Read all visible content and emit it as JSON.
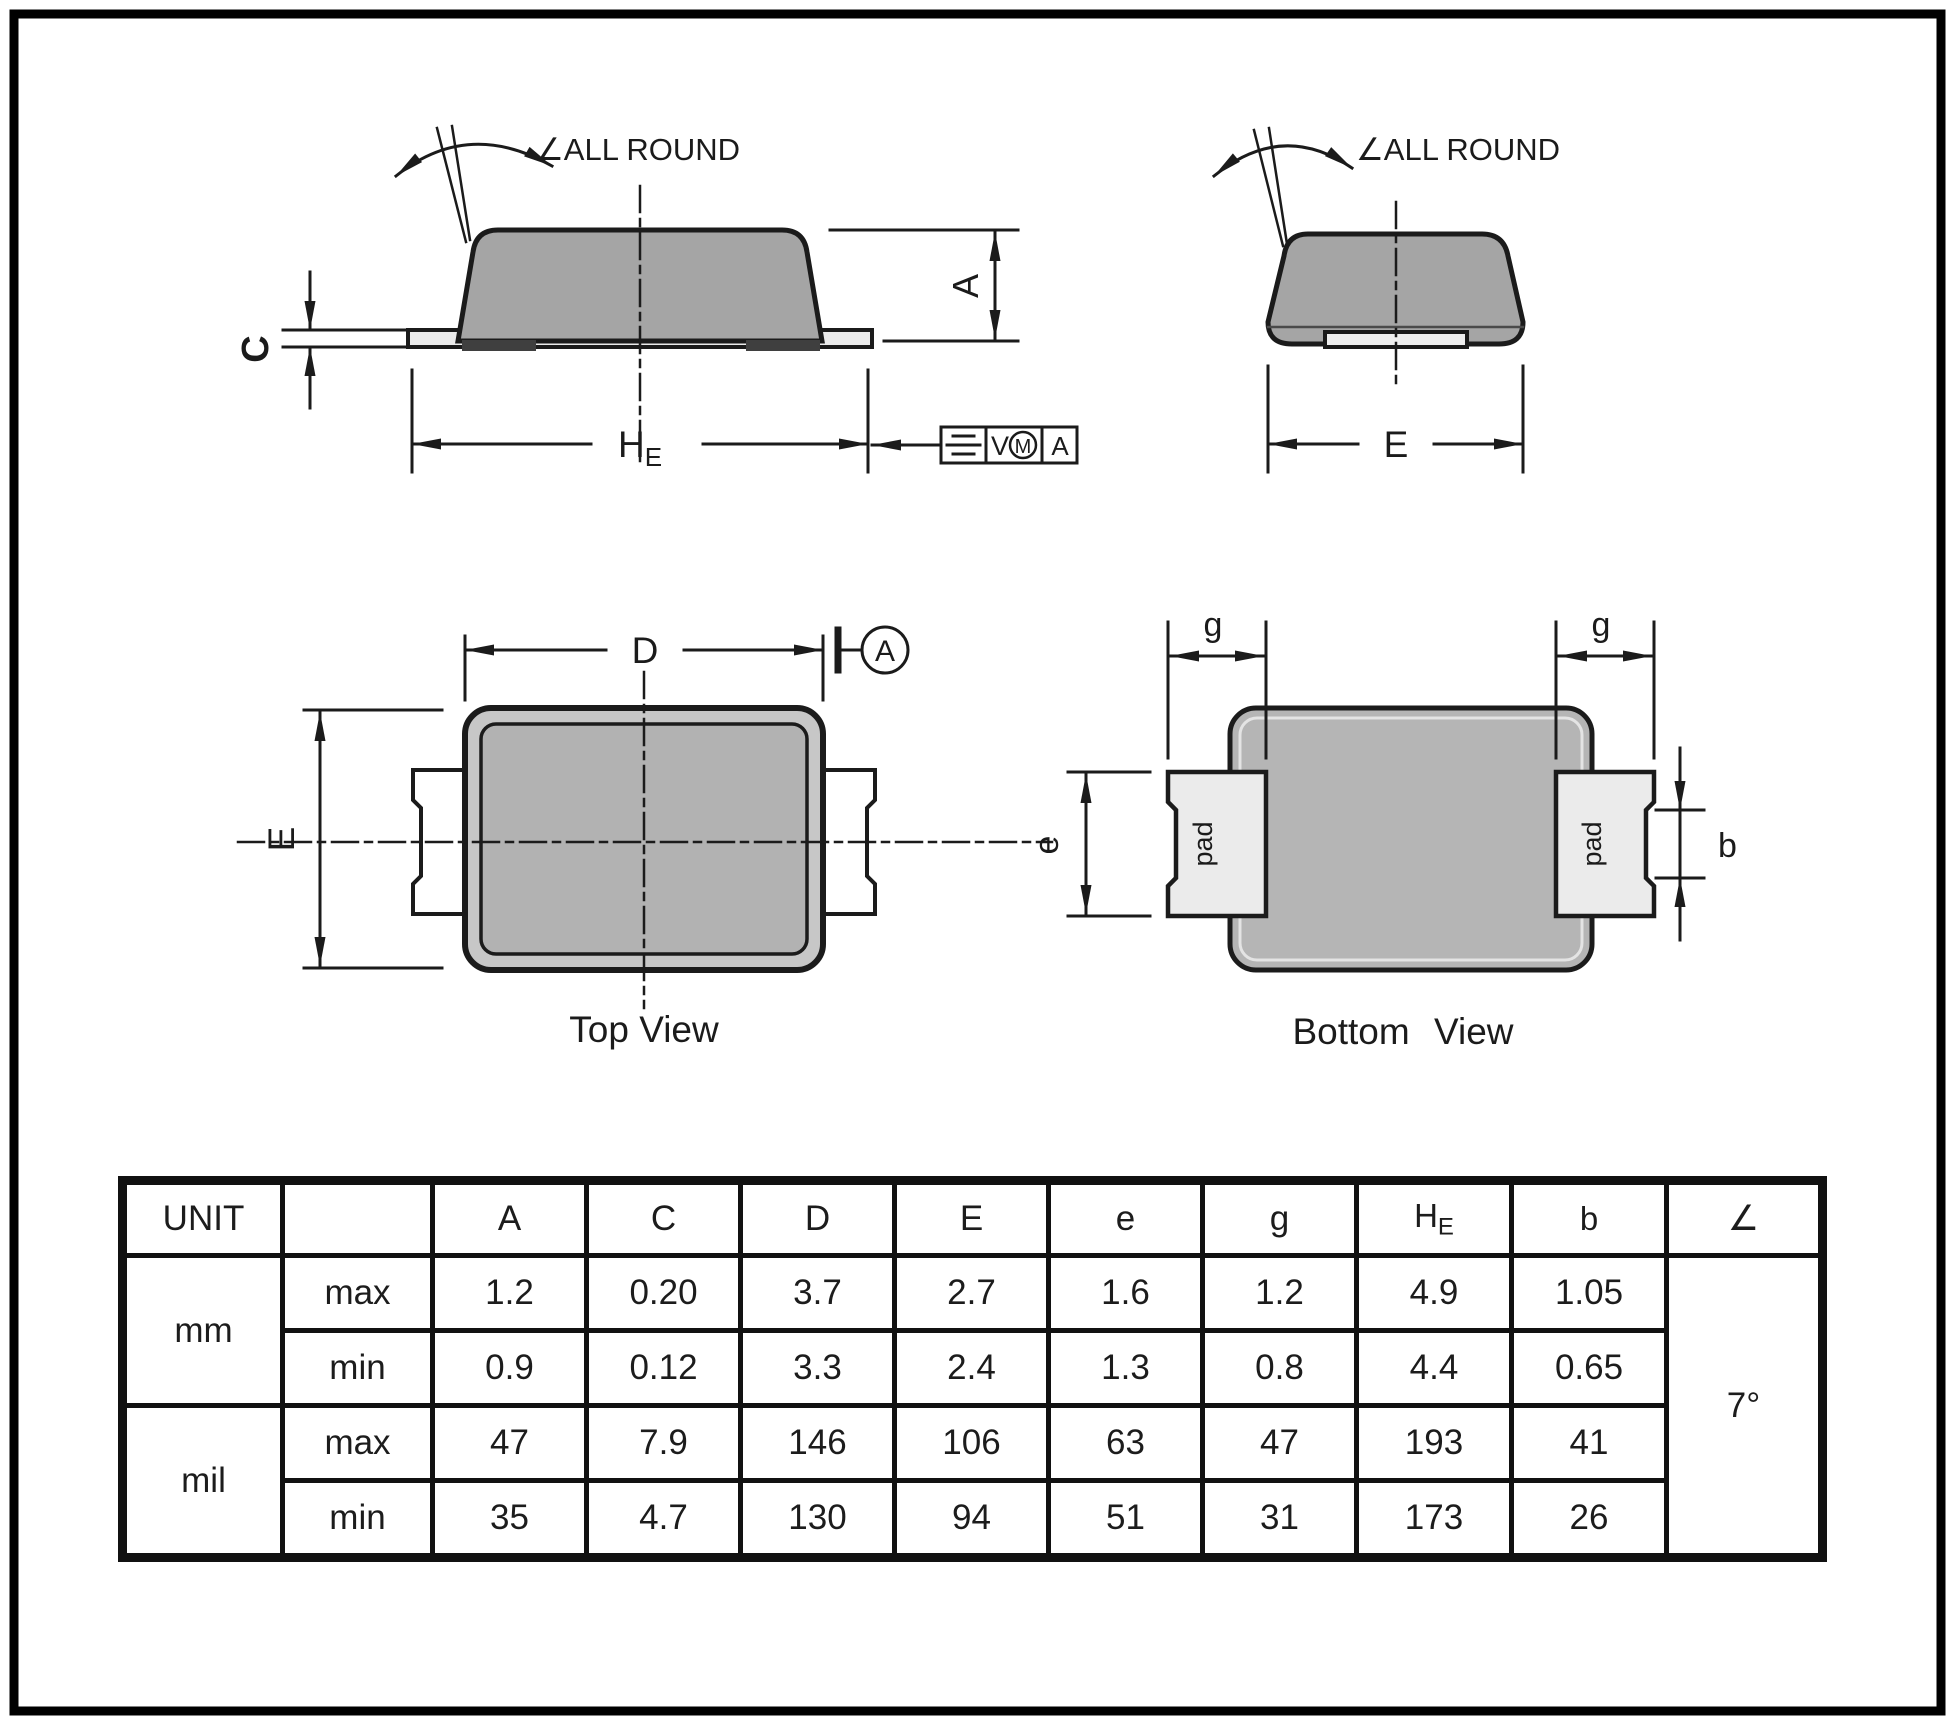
{
  "side_view": {
    "all_round": "∠ALL ROUND",
    "dim_c": "C",
    "dim_a": "A",
    "he_main": "H",
    "he_sub": "E",
    "fcf": {
      "v": "V",
      "m": "M",
      "datum": "A"
    }
  },
  "end_view": {
    "all_round": "∠ALL ROUND",
    "dim_e": "E"
  },
  "top_view": {
    "dim_d": "D",
    "dim_e": "E",
    "datum": "A",
    "caption": "Top View"
  },
  "bottom_view": {
    "g_left": "g",
    "g_right": "g",
    "dim_e": "e",
    "dim_b": "b",
    "pad_left": "pad",
    "pad_right": "pad",
    "caption": "Bottom View"
  },
  "table": {
    "unit_header": "UNIT",
    "col_a": "A",
    "col_c": "C",
    "col_d": "D",
    "col_e_upper": "E",
    "col_e_lower": "e",
    "col_g": "g",
    "col_he_main": "H",
    "col_he_sub": "E",
    "col_b": "b",
    "col_angle": "∠",
    "row_mm": "mm",
    "row_mil": "mil",
    "mm_max_label": "max",
    "mm_min_label": "min",
    "mil_max_label": "max",
    "mil_min_label": "min",
    "mm_max": [
      "1.2",
      "0.20",
      "3.7",
      "2.7",
      "1.6",
      "1.2",
      "4.9",
      "1.05"
    ],
    "mm_min": [
      "0.9",
      "0.12",
      "3.3",
      "2.4",
      "1.3",
      "0.8",
      "4.4",
      "0.65"
    ],
    "mil_max": [
      "47",
      "7.9",
      "146",
      "106",
      "63",
      "47",
      "193",
      "41"
    ],
    "mil_min": [
      "35",
      "4.7",
      "130",
      "94",
      "51",
      "31",
      "173",
      "26"
    ],
    "angle_value": "7°"
  },
  "colors": {
    "line": "#1b1b1b",
    "body_gray": "#a5a5a5",
    "top_rim_gray": "#c7c7c7",
    "top_inner_gray": "#b2b2b2",
    "bottom_body_gray": "#b5b5b5",
    "pad_light": "#ebebeb",
    "foot_dark": "#3f3f3f"
  }
}
